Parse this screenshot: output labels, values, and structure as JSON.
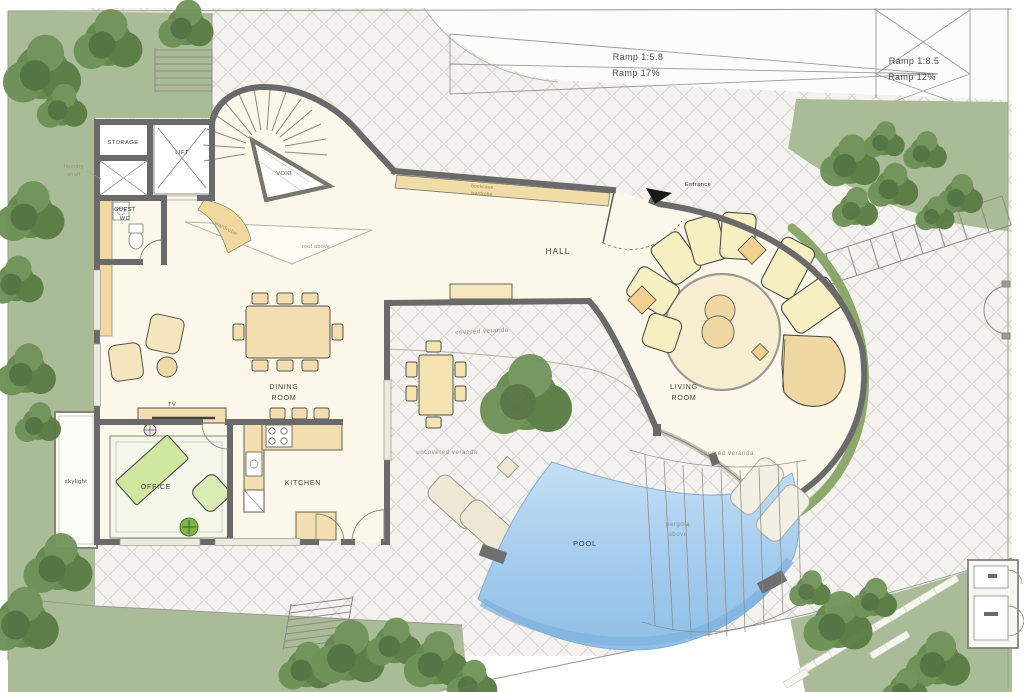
{
  "title": "Villa ground-floor site plan",
  "labels": {
    "storage": "STORAGE",
    "lift": "LIFT",
    "laundry1": "laundry",
    "laundry2": "shaft",
    "guest1": "GUEST",
    "guest2": "WC",
    "void": "VOID",
    "wardrobe": "wardrobe",
    "bookcase1": "bookcase",
    "bookcase2": "wardrobe",
    "roof_above": "roof above",
    "hall": "HALL",
    "entrance": "Entrance",
    "dining1": "DINING",
    "dining2": "ROOM",
    "living1": "LIVING",
    "living2": "ROOM",
    "kitchen": "KITCHEN",
    "office": "OFFICE",
    "tv": "TV",
    "skylight": "skylight",
    "pool": "POOL",
    "veranda_mid": "covered veranda",
    "veranda_unc": "uncovered veranda",
    "veranda_right": "covered veranda",
    "pergola1": "pergola",
    "pergola2": "above",
    "ramp1a": "Ramp 1:5.8",
    "ramp1b": "Ramp 17%",
    "ramp2a": "Ramp 1:8.5",
    "ramp2b": "Ramp 12%"
  },
  "colors": {
    "grass": "#a9bc97",
    "tree": "#64884c",
    "tile": "#f3f2ee",
    "tile_line": "#d4d3cc",
    "wall": "#6a6a6a",
    "floor": "#fbf8e9",
    "furniture": "#f2deae",
    "wardrobe_band": "#f1d89e",
    "office_green": "#cfe79f",
    "pool_light": "#bedcf4",
    "pool_deep": "#8fc0e6",
    "veranda_band": "#86a463"
  }
}
